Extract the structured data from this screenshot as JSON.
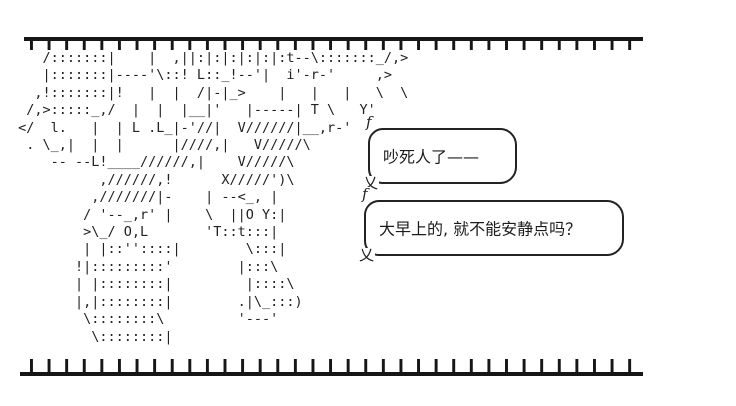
{
  "page": {
    "background": "#ffffff",
    "ink": "#1c1c1c"
  },
  "decor": {
    "top_rail": "tick-rail",
    "bottom_rail": "tick-rail"
  },
  "ascii_figure": {
    "description": "aa-character",
    "lines": [
      "    /:::::::|    |  ,||:|:|:|:|:|:t--\\:::::::_/,>",
      "    |:::::::|----'\\::! L::_!--'|  i'-r-'     ,>",
      "   ,!:::::::|!   |  |  /|-|_>    |   |   |   \\  \\",
      "  /,>:::::_,/  |  |  |__|'   |-----| T \\   Y'",
      " </  l.   |  | L .L_|-'//|  V//////|__,r-'",
      "  . \\_,|  |  |      |////,|   V/////\\",
      "     -- --L!____//////,|    V/////\\",
      "           ,//////,!      X/////')\\",
      "          ,///////|-    | --<_, |",
      "         / '--_,r' |    \\  ||O Y:|",
      "         >\\_/ O,L       'T::t:::|",
      "         | |::''::::|        \\:::|",
      "        !|:::::::::'        |:::\\",
      "        | |::::::::|         |::::\\",
      "        |,|::::::::|        .|\\_:::)",
      "         \\::::::::\\         '---'",
      "          \\::::::::|"
    ]
  },
  "bubbles": [
    {
      "tail_top_glyph": "f",
      "tail_bottom_glyph": "乂",
      "text": "吵死人了——"
    },
    {
      "tail_top_glyph": "f",
      "tail_bottom_glyph": "乂",
      "text": "大早上的, 就不能安静点吗？"
    }
  ]
}
